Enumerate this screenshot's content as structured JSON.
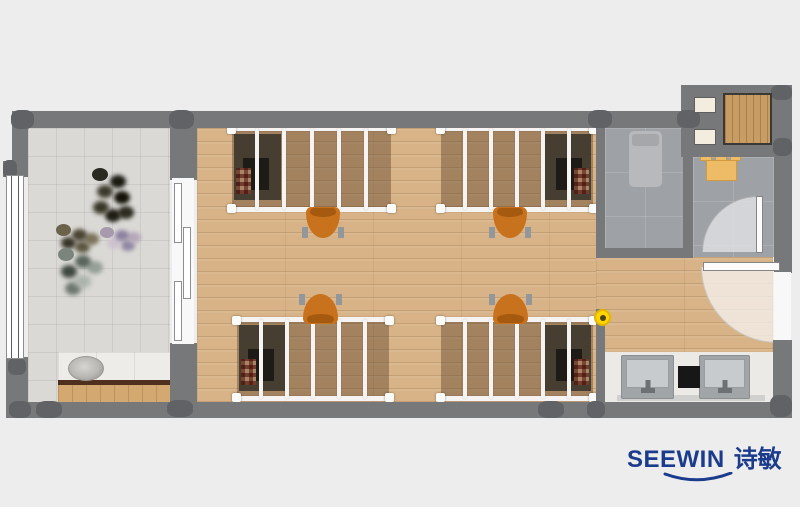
{
  "brand": {
    "name_en": "SEEWIN",
    "name_zh": "诗敏",
    "color": "#1b3c8c"
  },
  "palette": {
    "background": "#ededed",
    "wall": "#77787a",
    "column": "#616266",
    "wood_floor": "#d8b387",
    "balcony_tile": "#dbd9d6",
    "bath_tile": "#9ea1a5",
    "bed_frame": "#f5f4f2",
    "chair_orange": "#c9721d",
    "marker_yellow": "#ffd400",
    "counter_white": "#eceae7",
    "cabinet_wood": "#c89d64"
  },
  "plan": {
    "floors": [
      {
        "name": "balcony-floor",
        "kind": "tile",
        "rect": [
          28,
          128,
          142,
          274
        ]
      },
      {
        "name": "dorm-room-floor",
        "kind": "wood",
        "rect": [
          197,
          128,
          399,
          274
        ]
      },
      {
        "name": "entry-corridor-floor",
        "kind": "wood",
        "rect": [
          596,
          257,
          177,
          95
        ]
      },
      {
        "name": "shower-room-floor",
        "kind": "stone",
        "rect": [
          605,
          128,
          78,
          120
        ]
      },
      {
        "name": "toilet-room-floor",
        "kind": "stone",
        "rect": [
          693,
          157,
          81,
          100
        ]
      },
      {
        "name": "wash-area-counter",
        "kind": "counter",
        "rect": [
          605,
          352,
          168,
          50
        ]
      }
    ],
    "walls": [
      {
        "name": "wall-top",
        "rect": [
          13,
          111,
          679,
          17
        ]
      },
      {
        "name": "wall-annex-block",
        "rect": [
          681,
          85,
          111,
          72
        ]
      },
      {
        "name": "wall-left-upper",
        "rect": [
          12,
          111,
          16,
          56
        ]
      },
      {
        "name": "wall-left-stub",
        "rect": [
          3,
          161,
          25,
          16
        ]
      },
      {
        "name": "wall-left-lower",
        "rect": [
          6,
          357,
          22,
          61
        ]
      },
      {
        "name": "wall-bottom",
        "rect": [
          10,
          402,
          782,
          16
        ]
      },
      {
        "name": "wall-right-lower",
        "rect": [
          773,
          340,
          19,
          78
        ]
      },
      {
        "name": "wall-balcony-divider-upper",
        "rect": [
          170,
          123,
          27,
          57
        ]
      },
      {
        "name": "wall-balcony-divider-lower",
        "rect": [
          170,
          343,
          27,
          60
        ]
      },
      {
        "name": "wall-shower-left",
        "rect": [
          596,
          127,
          9,
          131
        ]
      },
      {
        "name": "wall-shower-bottom",
        "rect": [
          596,
          248,
          97,
          10
        ]
      },
      {
        "name": "wall-shower-toilet-divider",
        "rect": [
          683,
          127,
          10,
          131
        ]
      },
      {
        "name": "wall-toilet-right",
        "rect": [
          774,
          157,
          18,
          101
        ]
      },
      {
        "name": "wall-entry-right-stub",
        "rect": [
          774,
          257,
          18,
          16
        ]
      },
      {
        "name": "wall-passage-stub",
        "rect": [
          596,
          309,
          9,
          94
        ]
      }
    ],
    "columns": [
      [
        11,
        110,
        23,
        19
      ],
      [
        169,
        110,
        25,
        19
      ],
      [
        588,
        110,
        24,
        18
      ],
      [
        677,
        110,
        23,
        18
      ],
      [
        771,
        85,
        21,
        15
      ],
      [
        773,
        138,
        19,
        18
      ],
      [
        3,
        160,
        14,
        18
      ],
      [
        8,
        358,
        18,
        17
      ],
      [
        9,
        401,
        22,
        17
      ],
      [
        36,
        401,
        26,
        17
      ],
      [
        167,
        400,
        26,
        17
      ],
      [
        538,
        401,
        26,
        17
      ],
      [
        587,
        401,
        18,
        17
      ],
      [
        770,
        395,
        22,
        22
      ]
    ],
    "fixtures": [
      {
        "name": "balcony-window",
        "kind": "window",
        "rect": [
          6,
          175,
          18,
          184
        ]
      },
      {
        "name": "balcony-sliding-door-track",
        "kind": "white",
        "rect": [
          172,
          178,
          22,
          166
        ]
      },
      {
        "name": "sliding-door-panel",
        "kind": "slidepanel",
        "rect": [
          174,
          183,
          8,
          60
        ]
      },
      {
        "name": "sliding-door-panel",
        "kind": "slidepanel",
        "rect": [
          183,
          227,
          8,
          72
        ]
      },
      {
        "name": "sliding-door-panel",
        "kind": "slidepanel",
        "rect": [
          174,
          281,
          8,
          60
        ]
      },
      {
        "name": "laundry-counter-marble",
        "kind": "marble",
        "rect": [
          58,
          352,
          112,
          29
        ]
      },
      {
        "name": "laundry-sink",
        "kind": "ovalsink",
        "rect": [
          68,
          356,
          36,
          25
        ]
      },
      {
        "name": "laundry-counter-edge",
        "kind": "brown",
        "rect": [
          58,
          380,
          112,
          5
        ]
      },
      {
        "name": "laundry-cabinet-front",
        "kind": "woodstrip",
        "rect": [
          58,
          385,
          112,
          17
        ]
      },
      {
        "name": "wall-niche",
        "kind": "cream",
        "rect": [
          694,
          97,
          22,
          16
        ]
      },
      {
        "name": "wall-niche",
        "kind": "cream",
        "rect": [
          694,
          129,
          22,
          16
        ]
      },
      {
        "name": "storage-cabinet",
        "kind": "cabinet",
        "rect": [
          723,
          93,
          49,
          52
        ]
      },
      {
        "name": "shower-tray",
        "kind": "tray",
        "rect": [
          629,
          131,
          33,
          56
        ]
      },
      {
        "name": "shower-tray-head",
        "kind": "traytop",
        "rect": [
          632,
          134,
          27,
          12
        ]
      },
      {
        "name": "toilet-fixture-item",
        "kind": "orange",
        "rect": [
          700,
          150,
          12,
          11
        ]
      },
      {
        "name": "toilet-fixture-item",
        "kind": "orange",
        "rect": [
          715,
          148,
          12,
          14
        ]
      },
      {
        "name": "toilet-fixture-item",
        "kind": "orange",
        "rect": [
          730,
          150,
          11,
          11
        ]
      },
      {
        "name": "toilet-fixture",
        "kind": "orange",
        "rect": [
          706,
          160,
          31,
          21
        ]
      },
      {
        "name": "toilet-door-swing-arc",
        "kind": "arc-tl",
        "rect": [
          702,
          196,
          56,
          56
        ]
      },
      {
        "name": "toilet-door-leaf",
        "kind": "doorleaf",
        "rect": [
          756,
          196,
          7,
          57
        ]
      },
      {
        "name": "entry-door-swing-arc",
        "kind": "arc-bl",
        "rect": [
          701,
          267,
          76,
          76
        ]
      },
      {
        "name": "entry-door-leaf",
        "kind": "doorleaf",
        "rect": [
          703,
          262,
          77,
          9
        ]
      },
      {
        "name": "entry-side-window",
        "kind": "white",
        "rect": [
          774,
          272,
          17,
          68
        ]
      },
      {
        "name": "wash-sink",
        "kind": "sink",
        "rect": [
          621,
          355,
          53,
          44
        ]
      },
      {
        "name": "wash-sink",
        "kind": "sink",
        "rect": [
          699,
          355,
          51,
          44
        ]
      },
      {
        "name": "waste-bin",
        "kind": "blackbox",
        "rect": [
          678,
          366,
          22,
          22
        ]
      },
      {
        "name": "counter-shadow",
        "kind": "shadow",
        "rect": [
          617,
          395,
          148,
          6
        ]
      }
    ],
    "beds": [
      {
        "name": "loft-bed-top-left",
        "rect": [
          228,
          126,
          167,
          86
        ],
        "side": "left",
        "rails": 5
      },
      {
        "name": "loft-bed-top-right",
        "rect": [
          437,
          126,
          160,
          86
        ],
        "side": "right",
        "rails": 5
      },
      {
        "name": "loft-bed-bottom-left",
        "rect": [
          233,
          317,
          160,
          84
        ],
        "side": "left",
        "rails": 5
      },
      {
        "name": "loft-bed-bottom-right",
        "rect": [
          437,
          317,
          160,
          84
        ],
        "side": "right",
        "rails": 5
      }
    ],
    "chairs": [
      {
        "name": "desk-chair-top-left",
        "rect": [
          302,
          207,
          42,
          31
        ],
        "facing": "down"
      },
      {
        "name": "desk-chair-top-right",
        "rect": [
          489,
          207,
          42,
          31
        ],
        "facing": "down"
      },
      {
        "name": "desk-chair-bottom-left",
        "rect": [
          299,
          294,
          43,
          30
        ],
        "facing": "up"
      },
      {
        "name": "desk-chair-bottom-right",
        "rect": [
          489,
          294,
          43,
          30
        ],
        "facing": "up"
      }
    ],
    "plants": [
      {
        "name": "balcony-plant-cluster",
        "class": "p1",
        "pos": [
          92,
          168
        ]
      },
      {
        "name": "balcony-plant-cluster",
        "class": "p2",
        "pos": [
          56,
          224
        ]
      },
      {
        "name": "balcony-plant-cluster",
        "class": "p3",
        "pos": [
          100,
          227
        ]
      },
      {
        "name": "balcony-plant-cluster",
        "class": "p4",
        "pos": [
          58,
          248
        ]
      }
    ],
    "marker": {
      "name": "door-stop-marker",
      "rect": [
        594,
        309,
        17,
        17
      ]
    }
  }
}
